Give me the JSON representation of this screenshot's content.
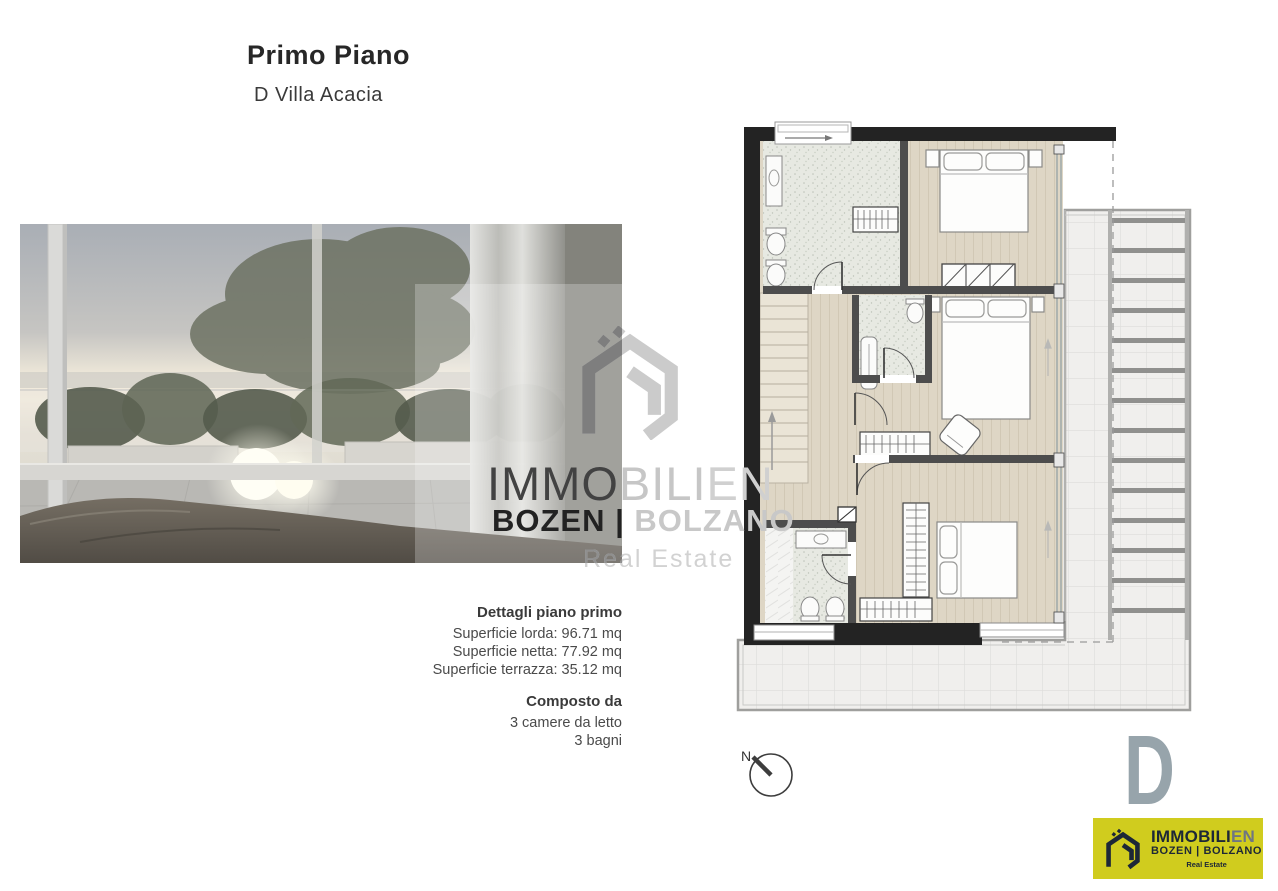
{
  "header": {
    "title": "Primo Piano",
    "subtitle": "D Villa Acacia"
  },
  "details": {
    "heading": "Dettagli piano primo",
    "area_lines": [
      "Superficie lorda: 96.71 mq",
      "Superficie netta: 77.92 mq",
      "Superficie terrazza: 35.12 mq"
    ],
    "composition_heading": "Composto da",
    "composition_lines": [
      "3 camere da letto",
      "3 bagni"
    ]
  },
  "watermark": {
    "brand_main": "IMMOBILI",
    "brand_suffix": "EN",
    "cities": "BOZEN | BOLZANO",
    "tagline": "Real Estate"
  },
  "floor_plan": {
    "compass_label": "N",
    "unit_letter": "D"
  },
  "logo": {
    "brand_main": "IMMOBILI",
    "brand_suffix": "EN",
    "cities": "BOZEN | BOLZANO",
    "tagline": "Real Estate"
  },
  "colors": {
    "logo_background": "#d0cc1e",
    "logo_navy": "#1d2737",
    "unit_letter_gray": "#97a4ab",
    "exterior_wall": "#232323",
    "wood_floor": "#ded6c5",
    "bath_tile": "#e7e9e2",
    "terrace_tile": "#f0efed"
  }
}
